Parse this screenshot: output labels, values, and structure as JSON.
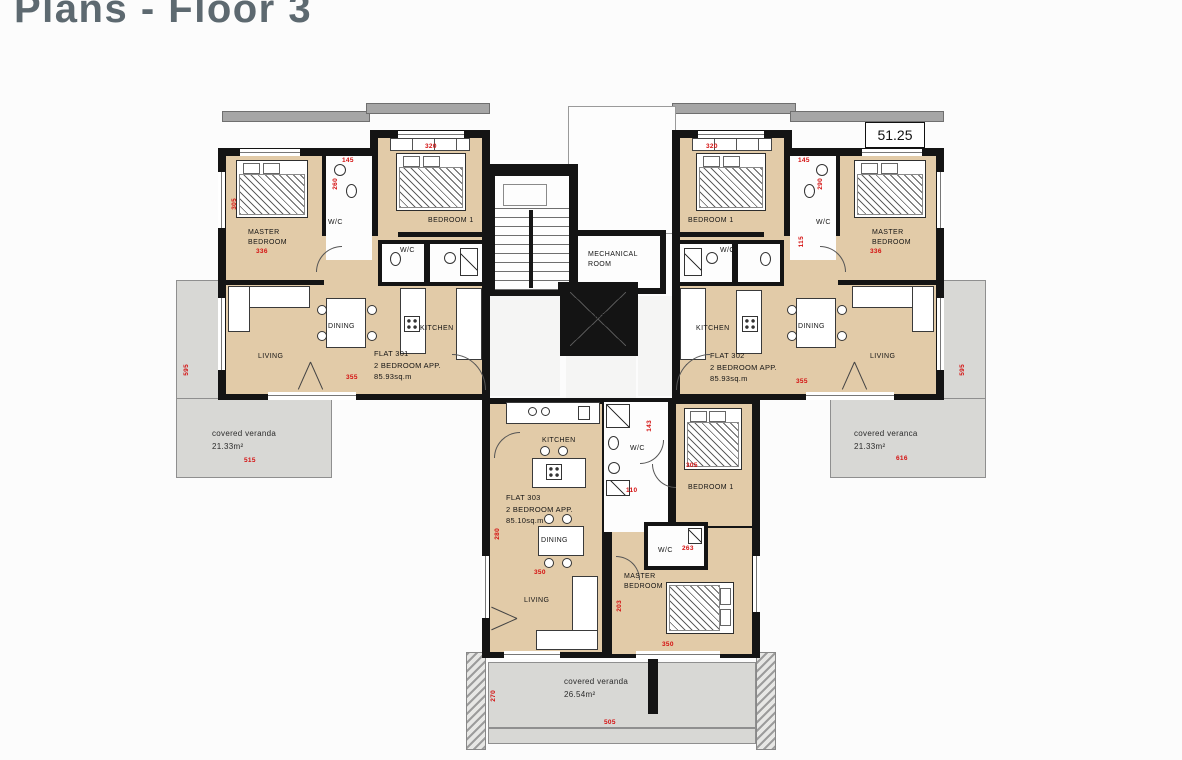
{
  "page": {
    "title": "Plans - Floor 3"
  },
  "colors": {
    "title": "#5d6970",
    "room_fill": "#e2cba8",
    "wall": "#141414",
    "veranda_fill": "#d8d8d5",
    "dimension_red": "#d40f0f"
  },
  "plan": {
    "level_marker": "51.25",
    "core": {
      "mechanical_room": "MECHANICAL ROOM",
      "lift": "LIFT"
    },
    "flat301": {
      "name": "FLAT 301",
      "type": "2 BEDROOM APP.",
      "area": "85.93sq.m",
      "master_bedroom": "MASTER BEDROOM",
      "bedroom1": "BEDROOM 1",
      "wc": "W/C",
      "wc2": "W/C",
      "living": "LIVING",
      "dining": "DINING",
      "kitchen": "KITCHEN"
    },
    "flat302": {
      "name": "FLAT 302",
      "type": "2 BEDROOM APP.",
      "area": "85.93sq.m",
      "master_bedroom": "MASTER BEDROOM",
      "bedroom1": "BEDROOM 1",
      "wc": "W/C",
      "wc2": "W/C",
      "living": "LIVING",
      "dining": "DINING",
      "kitchen": "KITCHEN"
    },
    "flat303": {
      "name": "FLAT 303",
      "type": "2 BEDROOM APP.",
      "area": "85.10sq.m",
      "master_bedroom": "MASTER BEDROOM",
      "bedroom1": "BEDROOM 1",
      "wc": "W/C",
      "wc2": "W/C",
      "living": "LIVING",
      "dining": "DINING",
      "kitchen": "KITCHEN"
    },
    "verandas": {
      "left": {
        "label": "covered veranda",
        "area": "21.33m²"
      },
      "right": {
        "label": "covered veranca",
        "area": "21.33m²"
      },
      "bottom": {
        "label": "covered veranda",
        "area": "26.54m²"
      }
    },
    "dims": [
      "320",
      "145",
      "260",
      "305",
      "336",
      "355",
      "320",
      "145",
      "290",
      "336",
      "115",
      "355",
      "515",
      "595",
      "616",
      "595",
      "110",
      "305",
      "143",
      "280",
      "350",
      "263",
      "203",
      "350",
      "270",
      "505"
    ]
  }
}
